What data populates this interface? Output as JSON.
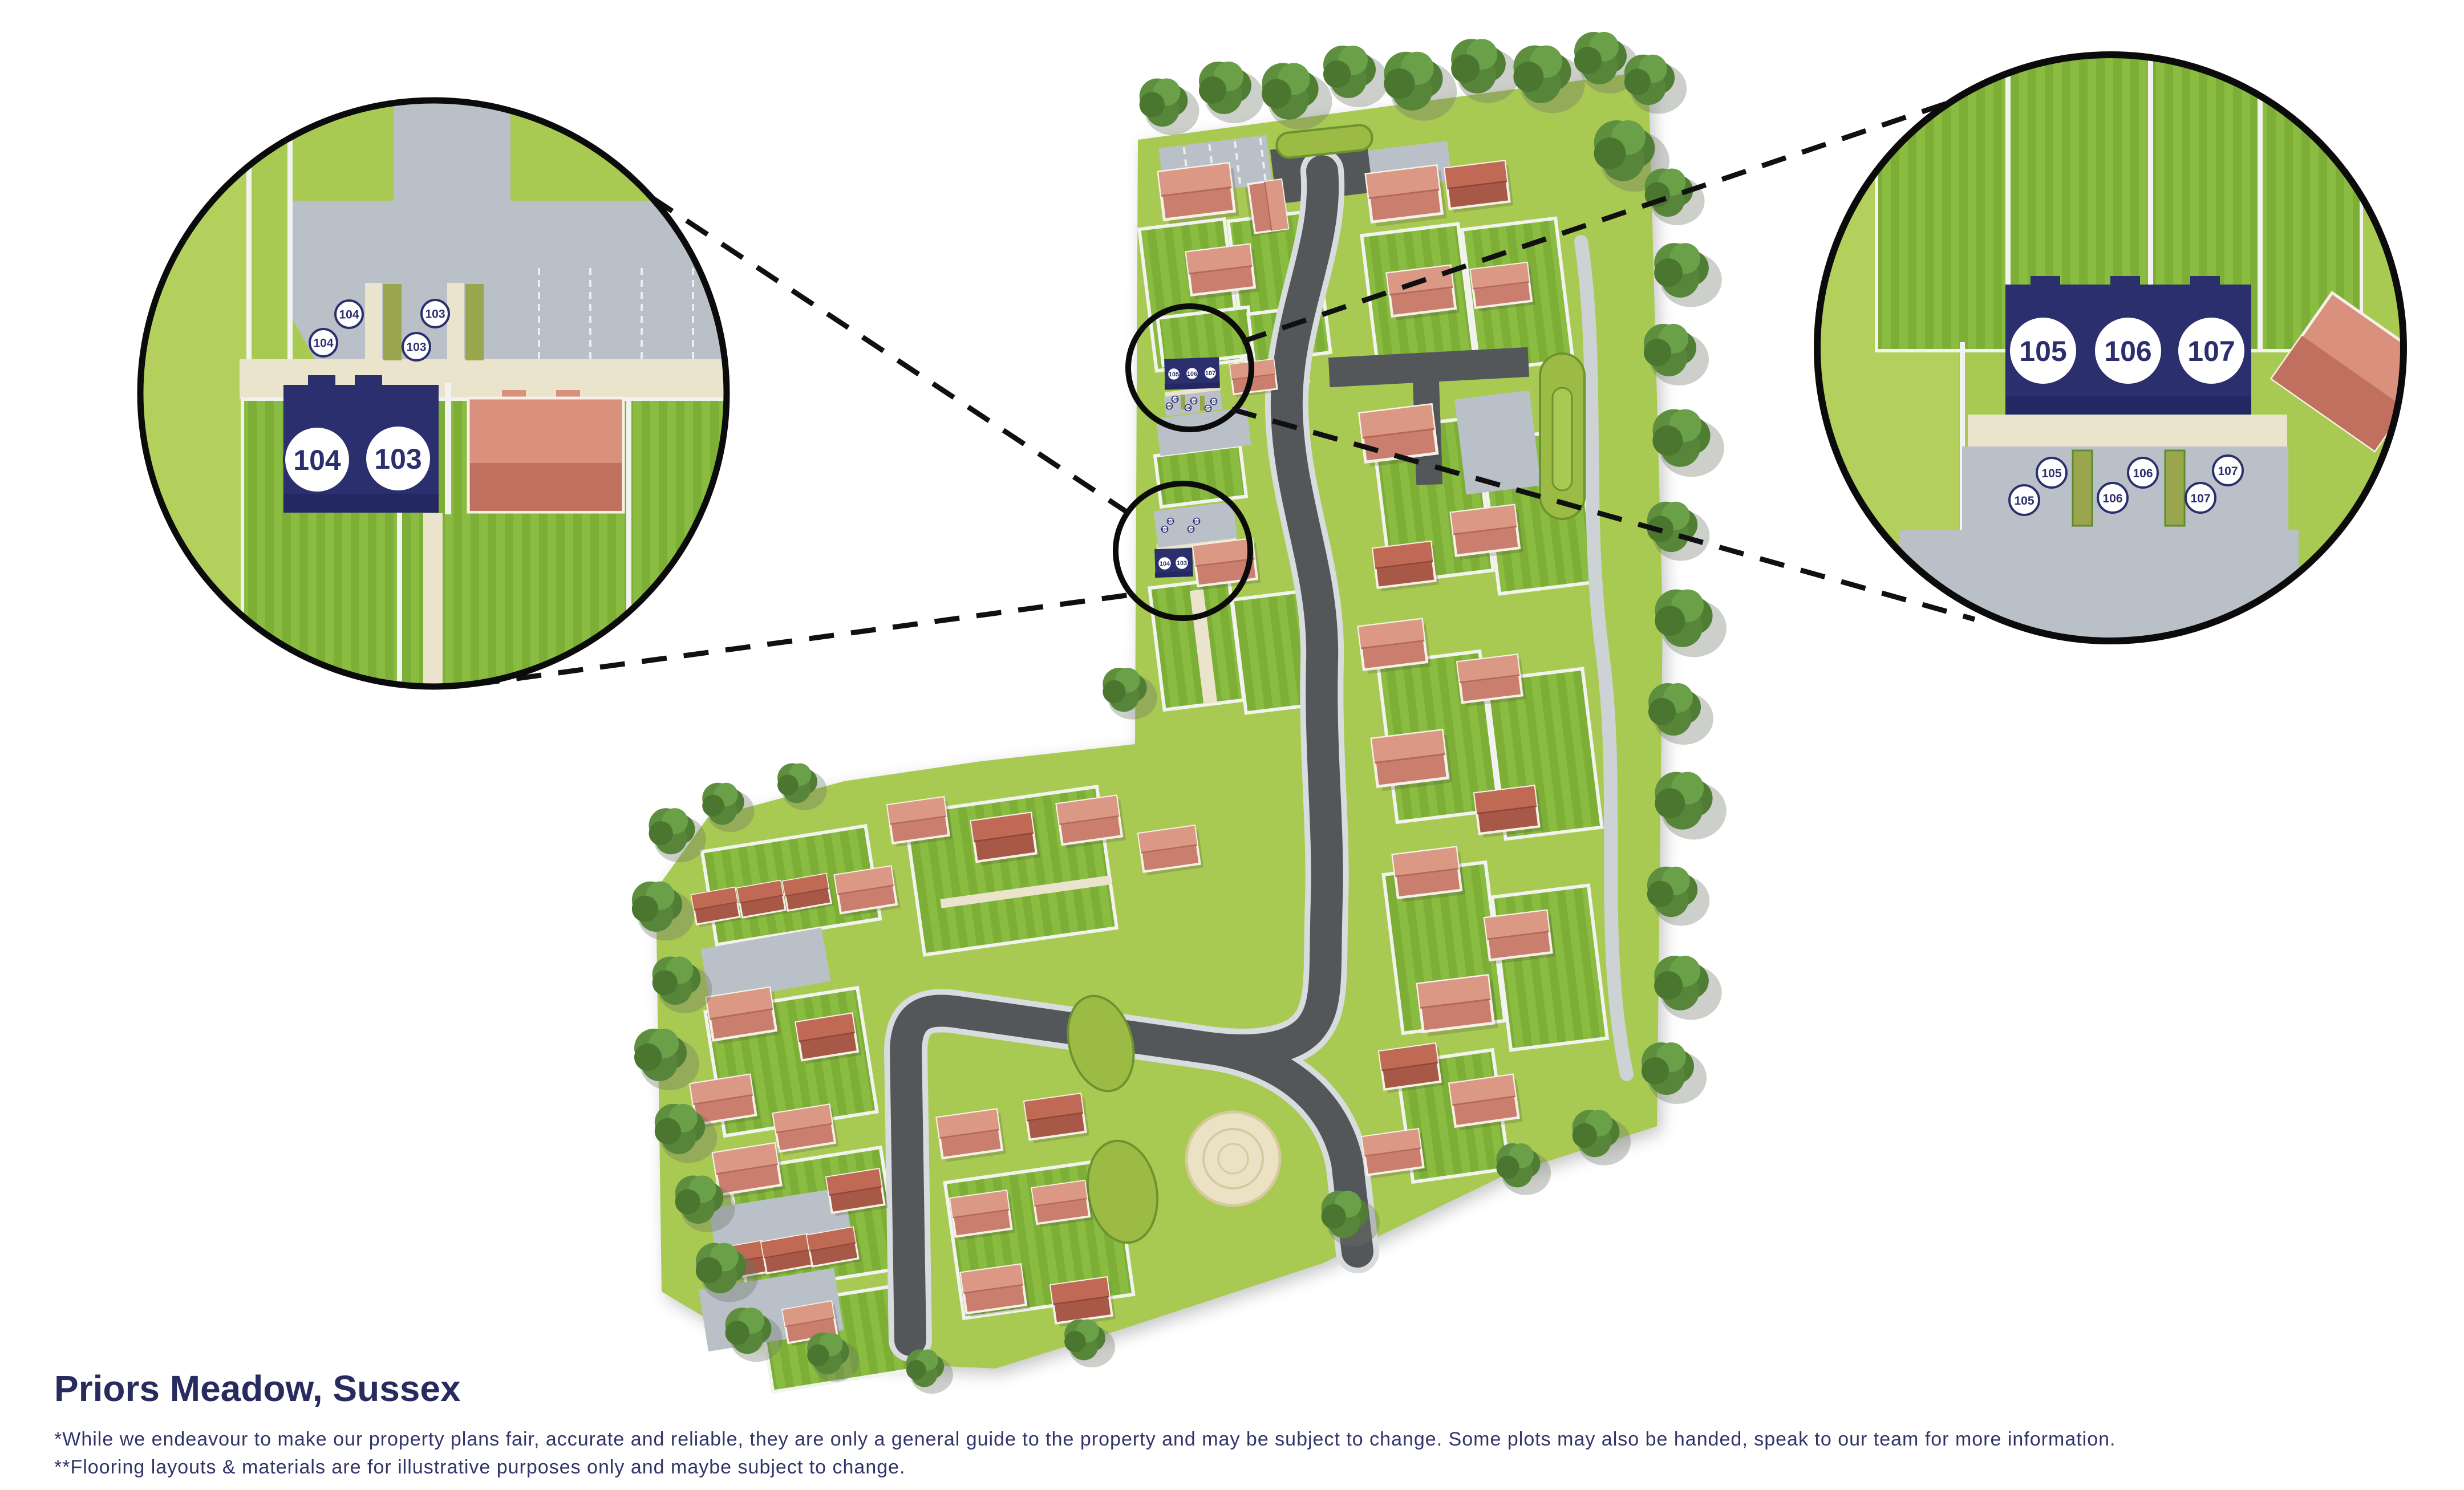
{
  "footer": {
    "title": "Priors Meadow, Sussex",
    "note1": "*While we endeavour to make our property plans fair, accurate and reliable, they are only a general guide to the property and may be subject to change. Some plots may also be handed, speak to our team for more information.",
    "note2": "**Flooring layouts & materials are for illustrative purposes only and maybe subject to change."
  },
  "callouts": {
    "left": {
      "plots": [
        "104",
        "103"
      ],
      "parking": [
        "104",
        "104",
        "103",
        "103"
      ]
    },
    "right": {
      "plots": [
        "105",
        "106",
        "107"
      ],
      "parking": [
        "105",
        "105",
        "106",
        "106",
        "107",
        "107"
      ]
    }
  },
  "map": {
    "terrace": {
      "plots": [
        "105",
        "106",
        "107"
      ],
      "parking": [
        "105",
        "105",
        "106",
        "106",
        "107",
        "107"
      ]
    },
    "semi": {
      "plots": [
        "104",
        "103"
      ],
      "parking": [
        "104",
        "104",
        "103",
        "103"
      ]
    }
  },
  "colors": {
    "navy": "#2b2f6e",
    "grass": "#a9ca52",
    "roof_salmon": "#db9884",
    "roof_dark": "#c06a55",
    "road": "#54575a",
    "parking": "#b9c0c7",
    "path_cream": "#ebe4cc"
  }
}
